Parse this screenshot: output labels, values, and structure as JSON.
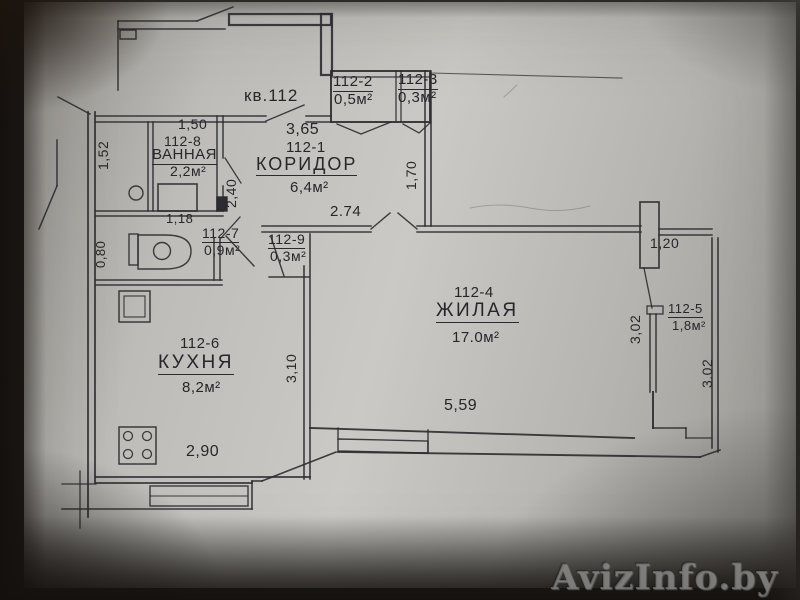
{
  "photo": {
    "watermark": "AvizInfo.by"
  },
  "plan": {
    "unit_label": "кв.112",
    "rooms": {
      "corridor": {
        "id": "112-1",
        "name": "КОРИДОР",
        "area": "6,4м²"
      },
      "closet_2": {
        "id": "112-2",
        "area": "0,5м²"
      },
      "closet_3": {
        "id": "112-3",
        "area": "0,3м²"
      },
      "living": {
        "id": "112-4",
        "name": "ЖИЛАЯ",
        "area": "17.0м²"
      },
      "loggia": {
        "id": "112-5",
        "area": "1,8м²"
      },
      "kitchen": {
        "id": "112-6",
        "name": "КУХНЯ",
        "area": "8,2м²"
      },
      "wc": {
        "id": "112-7",
        "area": "0,9м²"
      },
      "bathroom": {
        "id": "112-8",
        "name": "ВАННАЯ",
        "area": "2,2м²"
      },
      "closet_9": {
        "id": "112-9",
        "area": "0,3м²"
      }
    },
    "dimensions": {
      "bath_width": "1,50",
      "bath_height": "1,52",
      "corridor_height": "2,40",
      "wc_width": "1,18",
      "wc_height": "0,80",
      "corridor_width": "3,65",
      "hall_depth": "1,70",
      "living_door_span": "2.74",
      "kitchen_depth": "3,10",
      "living_width": "5,59",
      "kitchen_width": "2,90",
      "living_right_span": "1,20",
      "loggia_height_left": "3,02",
      "loggia_height_right": "3.02"
    }
  }
}
